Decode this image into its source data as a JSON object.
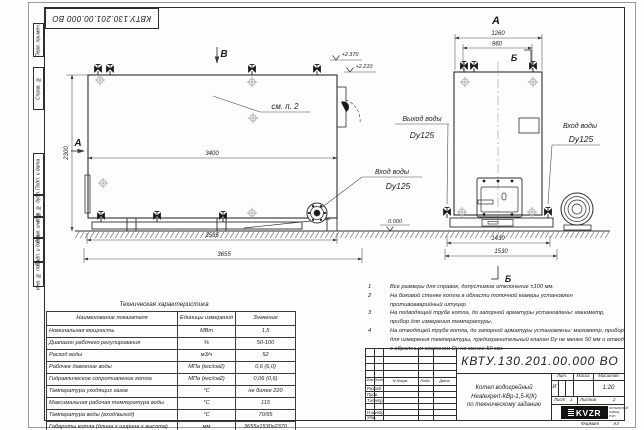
{
  "corner_stamp": {
    "text": "КВТУ.130.201.00.000  ВО"
  },
  "frame": {
    "columns": [
      {
        "label": "Перв. примен."
      },
      {
        "label": "Справ. №"
      },
      {
        "label": "Подп. и дата"
      },
      {
        "label": "Инв. № дубл."
      },
      {
        "label": "Взам. инв. №"
      },
      {
        "label": "Подп. и дата"
      },
      {
        "label": "Инв. № подл."
      }
    ]
  },
  "front_view": {
    "marker_a": "А",
    "marker_b": "В",
    "note_ref": "см. п. 2",
    "dim_length": "3400",
    "dim_height": "2300",
    "dim_base": "3535",
    "dim_total": "3655",
    "elev_top": "+2.370",
    "elev_top2": "+2.210",
    "inlet_label": "Вход воды",
    "inlet_size": "Dy125"
  },
  "side_view": {
    "view_title": "А",
    "section_marker": "Б",
    "dim_width": "1260",
    "dim_width_inner": "960",
    "dim_base": "1430",
    "dim_total": "1530",
    "elev_zero": "0.000",
    "outlet_label": "Выход воды",
    "outlet_size": "Dy125",
    "inlet_label": "Вход воды",
    "inlet_size": "Dy125"
  },
  "notes": {
    "items": [
      {
        "num": "1",
        "text": "Все размеры для справок, допустимое отклонение ±100 мм."
      },
      {
        "num": "2",
        "text": "На боковой стенке котла в области топочной камеры установлен противоаварийный штуцер"
      },
      {
        "num": "3",
        "text": "На  подводящей трубе котла, до запорной арматуры установлены: манометр, прибор для измерения температуры."
      },
      {
        "num": "4",
        "text": "На отводящей трубе котла, до запорной арматуры установлены: манометр, прибор для измерения температуры, предохранительный клапан Dу не менее 50 мм и отвод с обратным клапаном Dу не менее 50 мм."
      }
    ]
  },
  "spec_table": {
    "title": "Техническая характеристика",
    "headers": [
      "Наименование показателя",
      "Единицы измерения",
      "Значение"
    ],
    "rows": [
      [
        "Номинальная мощность",
        "МВт",
        "1,5"
      ],
      [
        "Диапазон рабочего регулирования",
        "%",
        "50-100"
      ],
      [
        "Расход воды",
        "м3/ч",
        "52"
      ],
      [
        "Рабочее давление воды",
        "МПа (кгс/см2)",
        "0,6 (6,0)"
      ],
      [
        "Гидравлическое сопротивление котла",
        "МПа (кгс/см2)",
        "0,06 (0,6)"
      ],
      [
        "Температура уходящих газов",
        "°С",
        "не более 220"
      ],
      [
        "Максимальная рабочая температура воды",
        "°С",
        "115"
      ],
      [
        "Температура воды (вход/выход)",
        "°С",
        "70/95"
      ],
      [
        "Габариты котла (длина х ширина х высота)",
        "мм",
        "3655х1530х2370"
      ]
    ]
  },
  "title_block": {
    "doc_number": "КВТУ.130.201.00.000  ВО",
    "col_izm": "Изм",
    "col_list": "Лист",
    "col_doc": "N докум.",
    "col_sign": "Подп.",
    "col_date": "Дата",
    "roles": [
      "Разраб.",
      "Пров.",
      "Т.контр.",
      "",
      "Н.контр.",
      "Утв."
    ],
    "title_line1": "Котел водогрейный",
    "title_line2": "Heatexpert-КВр-1,5-К(К)",
    "title_line3": "по техническому заданию",
    "lit_header": "Лит.",
    "mass_header": "Масса",
    "scale_header": "Масштаб",
    "lit_value": "И",
    "scale_value": "1:20",
    "sheet_label": "Лист",
    "sheet_value": "1",
    "sheets_label": "Листов",
    "sheets_value": "2",
    "logo_text": "KVZR",
    "company_line1": "КОТЕЛЬНЫЙ",
    "company_line2": "ЗАВОД РЭП",
    "format_label": "Формат",
    "format_value": "А3"
  }
}
